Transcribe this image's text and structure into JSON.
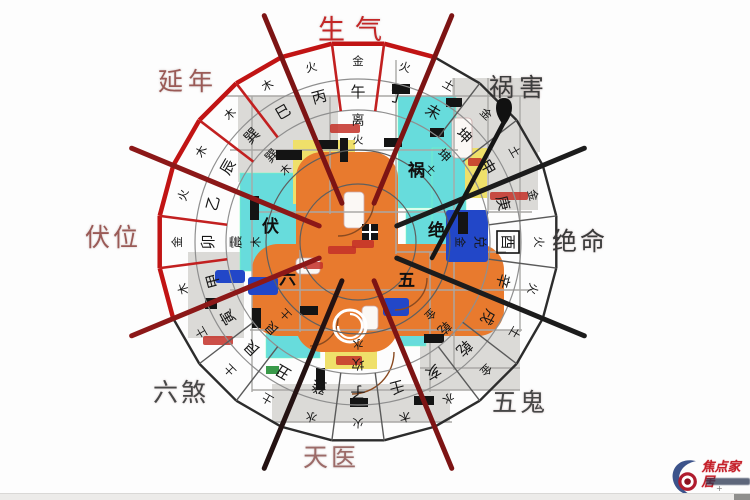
{
  "direction_labels": [
    {
      "text": "生气",
      "x": 318,
      "y": 8,
      "color": "#c32626",
      "size": 27,
      "spacing": 10
    },
    {
      "text": "祸害",
      "x": 489,
      "y": 68,
      "color": "#3d3d3d",
      "size": 25,
      "spacing": 5
    },
    {
      "text": "延年",
      "x": 158,
      "y": 62,
      "color": "#9a5a56",
      "size": 25,
      "spacing": 5
    },
    {
      "text": "伏位",
      "x": 85,
      "y": 218,
      "color": "#9a5a56",
      "size": 25,
      "spacing": 3
    },
    {
      "text": "绝命",
      "x": 552,
      "y": 222,
      "color": "#3a3a3a",
      "size": 25,
      "spacing": 3
    },
    {
      "text": "六煞",
      "x": 153,
      "y": 373,
      "color": "#474747",
      "size": 25,
      "spacing": 3
    },
    {
      "text": "五鬼",
      "x": 492,
      "y": 383,
      "color": "#474747",
      "size": 25,
      "spacing": 3
    },
    {
      "text": "天医",
      "x": 303,
      "y": 438,
      "color": "#9c6b68",
      "size": 25,
      "spacing": 3
    }
  ],
  "compass": {
    "center": {
      "x": 358,
      "y": 242
    },
    "radii": {
      "inner1": 58,
      "inner2": 92,
      "trigram_outer": 132,
      "stems_outer": 163,
      "outer": 200,
      "stem_text": 150,
      "element_text": 181,
      "trigram_text": 121,
      "trigram_elem_text": 102
    },
    "mountains": [
      {
        "name": "午",
        "element": "金",
        "angle": -90
      },
      {
        "name": "丁",
        "element": "火",
        "angle": -75
      },
      {
        "name": "未",
        "element": "土",
        "angle": -60
      },
      {
        "name": "坤",
        "element": "金",
        "angle": -45
      },
      {
        "name": "申",
        "element": "土",
        "angle": -30
      },
      {
        "name": "庚",
        "element": "金",
        "angle": -15
      },
      {
        "name": "酉",
        "element": "火",
        "angle": 0
      },
      {
        "name": "辛",
        "element": "火",
        "angle": 15
      },
      {
        "name": "戌",
        "element": "土",
        "angle": 30
      },
      {
        "name": "乾",
        "element": "金",
        "angle": 45
      },
      {
        "name": "亥",
        "element": "水",
        "angle": 60
      },
      {
        "name": "壬",
        "element": "木",
        "angle": 75
      },
      {
        "name": "子",
        "element": "火",
        "angle": 90
      },
      {
        "name": "癸",
        "element": "水",
        "angle": 105
      },
      {
        "name": "丑",
        "element": "土",
        "angle": 120
      },
      {
        "name": "艮",
        "element": "土",
        "angle": 135
      },
      {
        "name": "寅",
        "element": "土",
        "angle": 150
      },
      {
        "name": "甲",
        "element": "木",
        "angle": 165
      },
      {
        "name": "卯",
        "element": "金",
        "angle": 180
      },
      {
        "name": "乙",
        "element": "火",
        "angle": 195
      },
      {
        "name": "辰",
        "element": "木",
        "angle": 210
      },
      {
        "name": "巽",
        "element": "木",
        "angle": 225
      },
      {
        "name": "巳",
        "element": "木",
        "angle": 240
      },
      {
        "name": "丙",
        "element": "火",
        "angle": 255
      }
    ],
    "trigrams": [
      {
        "name": "离",
        "element": "火",
        "angle": -90
      },
      {
        "name": "坤",
        "element": "土",
        "angle": -45
      },
      {
        "name": "兑",
        "element": "金",
        "angle": 0
      },
      {
        "name": "乾",
        "element": "金",
        "angle": 45
      },
      {
        "name": "坎",
        "element": "水",
        "angle": 90
      },
      {
        "name": "艮",
        "element": "土",
        "angle": 135
      },
      {
        "name": "震",
        "element": "木",
        "angle": 180
      },
      {
        "name": "巽",
        "element": "木",
        "angle": 225
      }
    ],
    "inner_marks": [
      {
        "char": "祸",
        "x": 408,
        "y": 176
      },
      {
        "char": "绝",
        "x": 428,
        "y": 236
      },
      {
        "char": "五",
        "x": 398,
        "y": 286
      },
      {
        "char": "六",
        "x": 279,
        "y": 284
      },
      {
        "char": "伏",
        "x": 262,
        "y": 232
      }
    ],
    "highlight_mountain_angle": 0,
    "red_sector_centers": [
      -105,
      -90,
      -75,
      -150,
      -135,
      -120,
      165,
      180,
      -165
    ],
    "boundary_lines": [
      {
        "angle": -112.5,
        "color": "#7d1414"
      },
      {
        "angle": -67.5,
        "color": "#7d1414"
      },
      {
        "angle": -22.5,
        "color": "#1c1c1c"
      },
      {
        "angle": 22.5,
        "color": "#1c1c1c"
      },
      {
        "angle": 67.5,
        "color": "#7d1414"
      },
      {
        "angle": 112.5,
        "color": "#241212"
      },
      {
        "angle": 157.5,
        "color": "#8c1818"
      },
      {
        "angle": -157.5,
        "color": "#8c1818"
      }
    ],
    "colors": {
      "red_ring": "#c11414",
      "dark_ring": "#2c2c2c",
      "grid": "#8f8f8f",
      "spoke": "#5a5a5a",
      "red_spoke": "#c22020",
      "text": "#161616"
    }
  },
  "floorplan": {
    "gray": [
      [
        238,
        96,
        100,
        86
      ],
      [
        452,
        78,
        88,
        74
      ],
      [
        488,
        152,
        50,
        58
      ],
      [
        188,
        252,
        56,
        86
      ],
      [
        420,
        330,
        100,
        60
      ],
      [
        272,
        384,
        178,
        38
      ]
    ],
    "cyan": [
      [
        240,
        173,
        62,
        98
      ],
      [
        398,
        96,
        58,
        112
      ],
      [
        406,
        210,
        56,
        76
      ],
      [
        266,
        270,
        54,
        88
      ],
      [
        432,
        148,
        34,
        88
      ],
      [
        400,
        312,
        26,
        34
      ]
    ],
    "yellow": [
      [
        293,
        140,
        62,
        64
      ],
      [
        465,
        148,
        22,
        50
      ],
      [
        325,
        350,
        52,
        19
      ]
    ],
    "orange": [
      [
        296,
        152,
        102,
        200
      ],
      [
        252,
        244,
        252,
        92
      ]
    ],
    "blue": [
      [
        446,
        210,
        42,
        52
      ],
      [
        215,
        270,
        30,
        13
      ],
      [
        248,
        277,
        30,
        18
      ],
      [
        383,
        298,
        26,
        18
      ]
    ],
    "white": [
      [
        344,
        192,
        20,
        36
      ],
      [
        296,
        258,
        24,
        16
      ],
      [
        362,
        306,
        16,
        24
      ],
      [
        452,
        118,
        20,
        40
      ]
    ],
    "green": [
      [
        266,
        366,
        13,
        8
      ]
    ],
    "red_marks": [
      [
        328,
        246,
        28,
        8
      ],
      [
        303,
        262,
        20,
        7
      ],
      [
        203,
        336,
        30,
        9
      ],
      [
        330,
        124,
        30,
        9
      ],
      [
        490,
        192,
        38,
        8
      ],
      [
        352,
        240,
        22,
        8
      ],
      [
        468,
        158,
        14,
        8
      ],
      [
        336,
        356,
        26,
        9
      ]
    ],
    "doors": [
      [
        318,
        140,
        20,
        9
      ],
      [
        384,
        138,
        18,
        9
      ],
      [
        276,
        150,
        26,
        10
      ],
      [
        250,
        196,
        9,
        24
      ],
      [
        392,
        84,
        18,
        10
      ],
      [
        446,
        98,
        16,
        9
      ],
      [
        458,
        212,
        10,
        22
      ],
      [
        424,
        334,
        20,
        9
      ],
      [
        316,
        368,
        9,
        22
      ],
      [
        300,
        306,
        18,
        9
      ],
      [
        252,
        308,
        9,
        20
      ],
      [
        414,
        396,
        20,
        9
      ],
      [
        350,
        398,
        18,
        9
      ],
      [
        430,
        128,
        14,
        9
      ],
      [
        340,
        138,
        8,
        24
      ],
      [
        205,
        298,
        12,
        11
      ]
    ],
    "window": [
      362,
      224,
      16,
      16
    ],
    "walls_h": [
      [
        225,
        96,
        312
      ],
      [
        230,
        150,
        228
      ],
      [
        250,
        212,
        282
      ],
      [
        230,
        290,
        302
      ],
      [
        250,
        330,
        272
      ],
      [
        252,
        390,
        268
      ],
      [
        272,
        422,
        180
      ],
      [
        396,
        252,
        110
      ],
      [
        420,
        368,
        100
      ]
    ],
    "walls_v": [
      [
        252,
        96,
        296
      ],
      [
        330,
        96,
        118
      ],
      [
        396,
        60,
        194
      ],
      [
        454,
        78,
        292
      ],
      [
        520,
        96,
        236
      ],
      [
        300,
        250,
        82
      ],
      [
        430,
        252,
        140
      ],
      [
        488,
        78,
        136
      ]
    ],
    "arcs": [
      [
        338,
        200,
        36
      ],
      [
        352,
        352,
        42
      ],
      [
        395,
        278,
        32
      ],
      [
        310,
        318,
        28
      ]
    ],
    "swirl": {
      "x": 350,
      "y": 326,
      "r": 16
    },
    "pin": {
      "x": 504,
      "y": 108,
      "line_to_x": 432,
      "line_to_y": 258
    }
  },
  "watermark": {
    "brand": "焦点家居"
  }
}
